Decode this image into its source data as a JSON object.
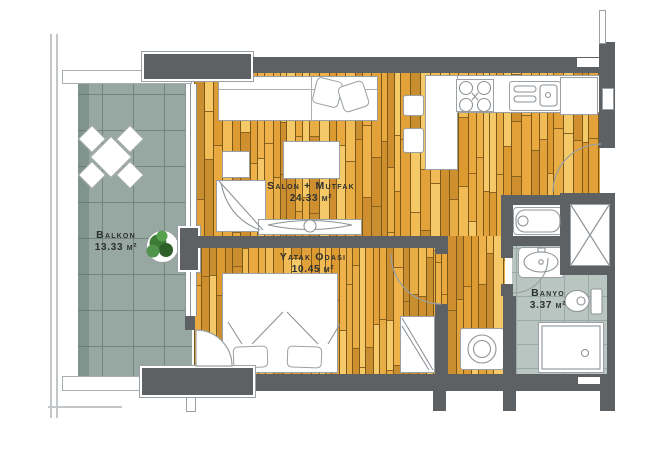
{
  "plan": {
    "rooms": [
      {
        "id": "balkon",
        "name": "Balkon",
        "area": "13.33 m²"
      },
      {
        "id": "salon",
        "name": "Salon + Mutfak",
        "area": "24.33 m²"
      },
      {
        "id": "yatak",
        "name": "Yatak Odası",
        "area": "10.45 m²"
      },
      {
        "id": "banyo",
        "name": "Banyo",
        "area": "3.37 m²"
      }
    ],
    "fixtures": [
      "sofa",
      "sofa-pillows",
      "side-table",
      "armchair",
      "coffee-table",
      "tv-unit",
      "kitchen-counter",
      "tall-cabinet",
      "stove",
      "kitchen-sink",
      "fridge",
      "bar-stools",
      "double-bed",
      "bed-pillows",
      "wardrobe",
      "washing-machine",
      "bathtub",
      "washbasin",
      "toilet",
      "shower-tray",
      "ventilation-shaft",
      "balcony-table-set",
      "potted-plant",
      "door-swing-arcs",
      "windows",
      "glass-railing"
    ],
    "colors": {
      "wall": "#5d6164",
      "outline": "#9aa0a3",
      "text": "#2d3032",
      "balcony_tile": "#97a8a2",
      "balcony_grid": "#72857f",
      "bath_tile": "#b9c5c0",
      "bath_grid": "#99a9a3",
      "wood_palette": [
        "#eaa93f",
        "#f1bb55",
        "#dd9a31",
        "#f5c968",
        "#e2a139",
        "#d08f2e",
        "#efb14a",
        "#e8ae45",
        "#c98e2f"
      ]
    }
  }
}
